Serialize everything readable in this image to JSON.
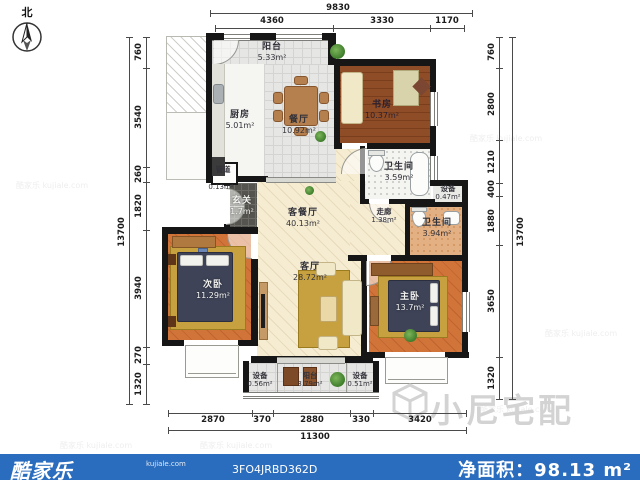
{
  "compass": {
    "north_label": "北"
  },
  "rooms": {
    "balcony_top": {
      "name": "阳台",
      "area": "5.33m²"
    },
    "kitchen": {
      "name": "厨房",
      "area": "5.01m²"
    },
    "dining": {
      "name": "餐厅",
      "area": "10.92m²"
    },
    "study": {
      "name": "书房",
      "area": "10.37m²"
    },
    "bath1": {
      "name": "卫生间",
      "area": "3.59m²"
    },
    "duct": {
      "name": "管道",
      "area": "0.13m²"
    },
    "entry": {
      "name": "玄关",
      "area": "1.7m²"
    },
    "living_dining": {
      "name": "客餐厅",
      "area": "40.13m²"
    },
    "living": {
      "name": "客厅",
      "area": "28.72m²"
    },
    "corridor": {
      "name": "走廊",
      "area": "1.38m²"
    },
    "equip1": {
      "name": "设备",
      "area": "0.47m²"
    },
    "bath2": {
      "name": "卫生间",
      "area": "3.94m²"
    },
    "bedroom2": {
      "name": "次卧",
      "area": "11.29m²"
    },
    "master": {
      "name": "主卧",
      "area": "13.7m²"
    },
    "equip2": {
      "name": "设备",
      "area": "0.56m²"
    },
    "balcony_bottom": {
      "name": "阳台",
      "area": "3.79m²"
    },
    "equip3": {
      "name": "设备",
      "area": "0.51m²"
    }
  },
  "dims": {
    "top": {
      "total": "9830",
      "segments": [
        "4360",
        "3330",
        "1170"
      ]
    },
    "bottom": {
      "total": "11300",
      "segments": [
        "2870",
        "370",
        "2880",
        "330",
        "3420"
      ]
    },
    "left": {
      "total": "13700",
      "segments": [
        "760",
        "3540",
        "260",
        "1820",
        "3940",
        "270",
        "1320"
      ]
    },
    "right": {
      "total": "13700",
      "segments": [
        "760",
        "2800",
        "1210",
        "400",
        "1880",
        "3650",
        "1320"
      ]
    }
  },
  "watermark": {
    "main": "小尼宅配",
    "tiled": "酷家乐 kujiale.com"
  },
  "footer": {
    "brand": "酷家乐",
    "brand_sub": "kujiale.com",
    "code": "3FO4JRBD362D",
    "area_label": "净面积：98.13 m²",
    "bg_color": "#2a6cbd"
  }
}
